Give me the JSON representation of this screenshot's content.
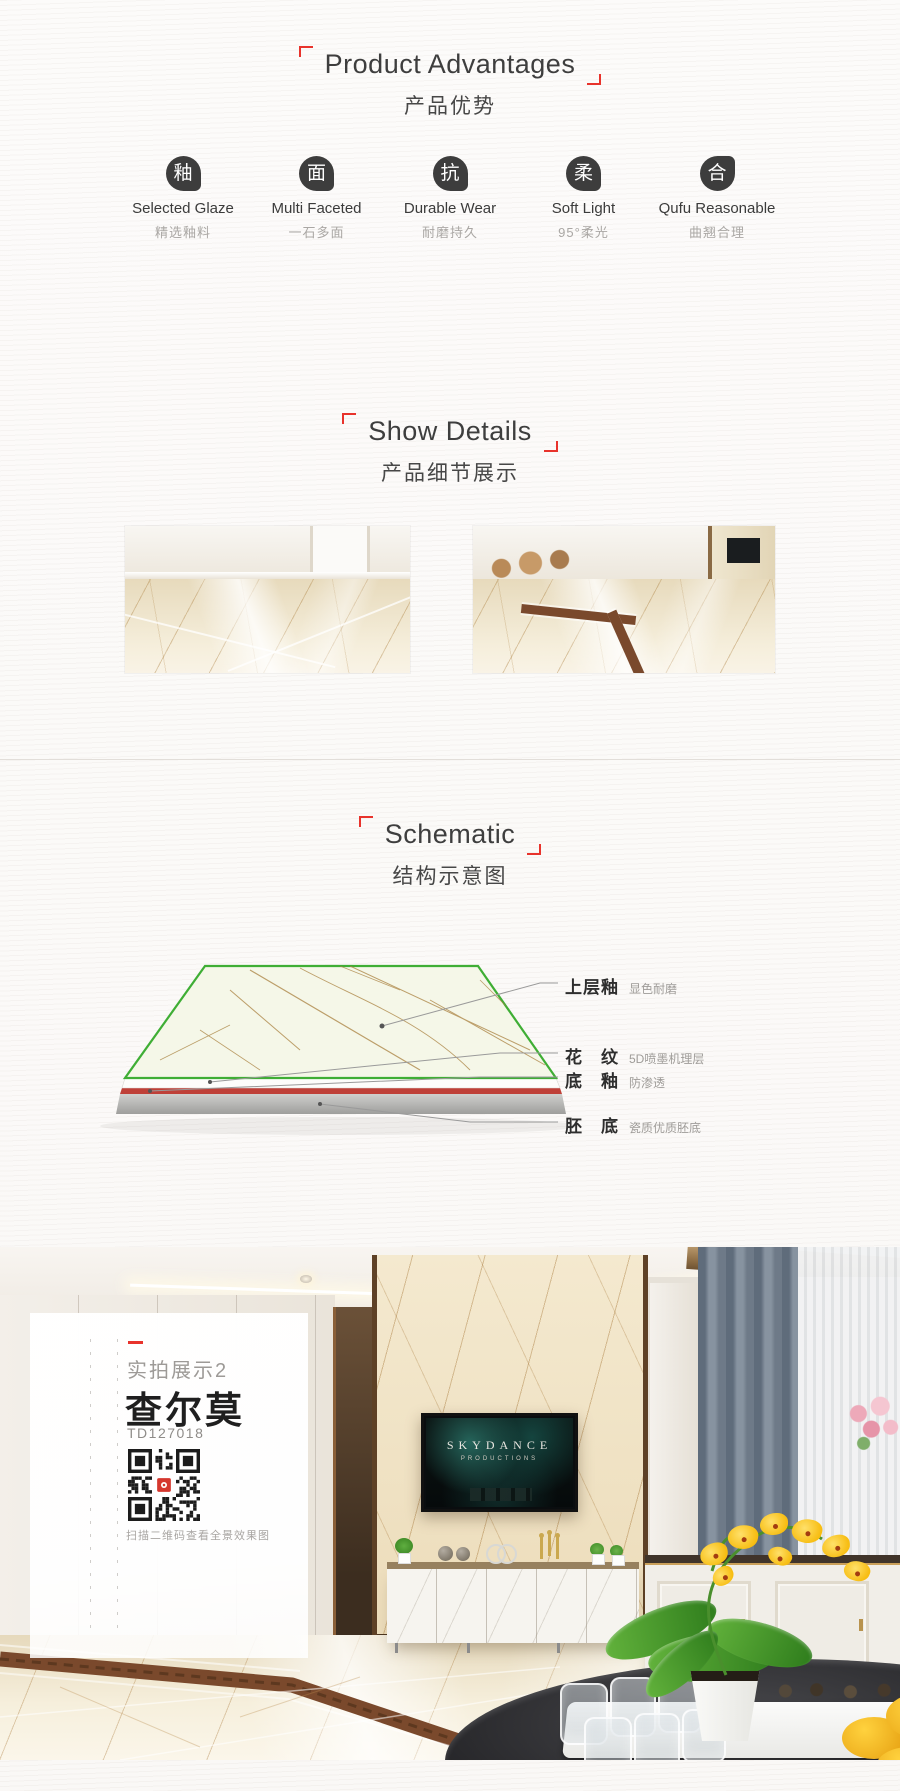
{
  "advantages": {
    "title_en": "Product Advantages",
    "title_zh": "产品优势",
    "items": [
      {
        "icon_char": "釉",
        "label_en": "Selected Glaze",
        "label_zh": "精选釉料"
      },
      {
        "icon_char": "面",
        "label_en": "Multi Faceted",
        "label_zh": "一石多面"
      },
      {
        "icon_char": "抗",
        "label_en": "Durable Wear",
        "label_zh": "耐磨持久"
      },
      {
        "icon_char": "柔",
        "label_en": "Soft Light",
        "label_zh": "95°柔光"
      },
      {
        "icon_char": "合",
        "label_en": "Qufu Reasonable",
        "label_zh": "曲翘合理"
      }
    ]
  },
  "details": {
    "title_en": "Show Details",
    "title_zh": "产品细节展示"
  },
  "schematic": {
    "title_en": "Schematic",
    "title_zh": "结构示意图",
    "labels": [
      {
        "name": "上层釉",
        "desc": "显色耐磨"
      },
      {
        "name": "花　纹",
        "desc": "5D喷墨机理层"
      },
      {
        "name": "底　釉",
        "desc": "防渗透"
      },
      {
        "name": "胚　底",
        "desc": "瓷质优质胚底"
      }
    ]
  },
  "showcase": {
    "tag": "实拍展示2",
    "product_name": "查尔莫",
    "model": "TD127018",
    "qr_caption": "扫描二维码查看全景效果图",
    "tv_brand": "SKYDANCE",
    "tv_sub": "PRODUCTIONS"
  },
  "colors": {
    "accent_red": "#e8332c",
    "icon_dark": "#3d3d3d",
    "schematic_green": "#3fae35",
    "schematic_layer_red": "#bf4038",
    "inlay_brown": "#7a492c"
  }
}
